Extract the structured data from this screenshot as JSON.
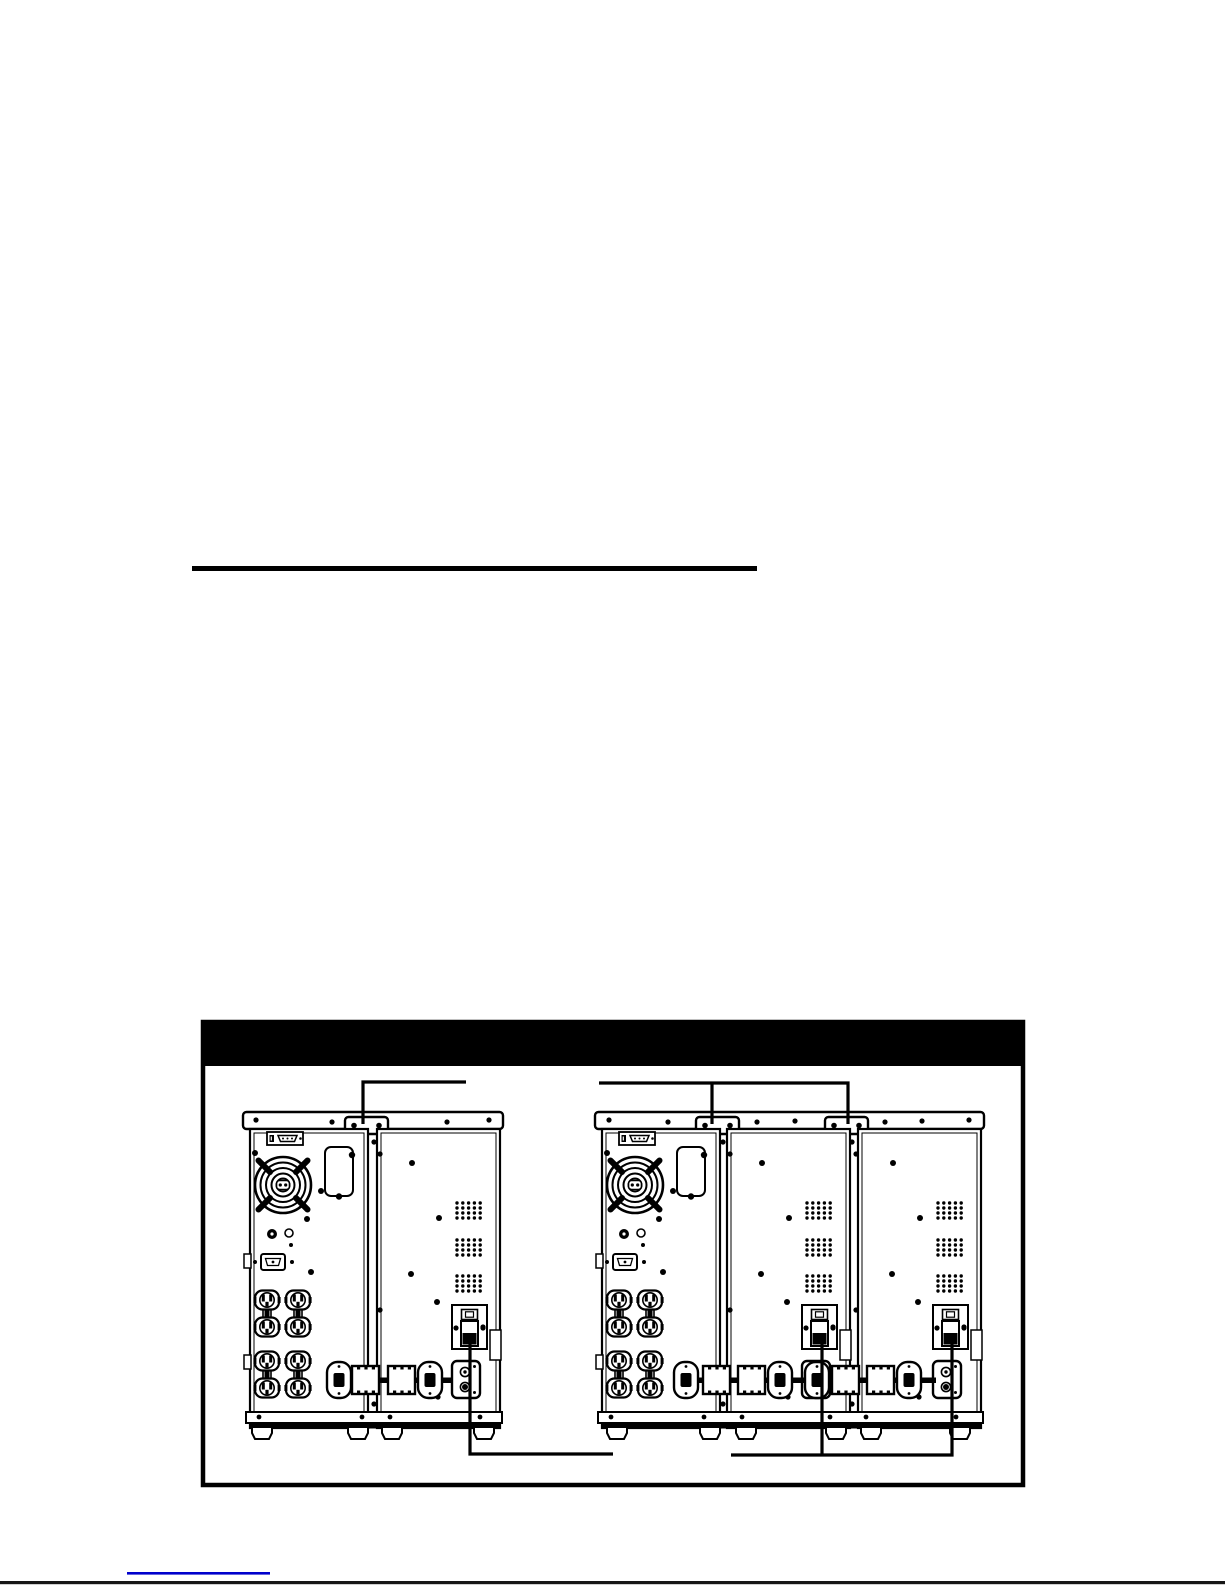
{
  "page": {
    "background_color": "#ffffff"
  },
  "divider_rule": {
    "color": "#000000"
  },
  "figure": {
    "title_bar_color": "#000000",
    "artwork_color": "#000000",
    "frame_color": "#000000",
    "groups": [
      {
        "id": "ups-with-one-battery-pack",
        "ups_units": 1,
        "battery_packs": 1,
        "top_callouts": 1,
        "bottom_callouts": 1
      },
      {
        "id": "ups-with-two-battery-packs",
        "ups_units": 1,
        "battery_packs": 2,
        "top_callouts": 2,
        "bottom_callouts": 2
      }
    ]
  },
  "footer": {
    "link_color": "#0000cc",
    "page_edge_color": "#161616"
  }
}
